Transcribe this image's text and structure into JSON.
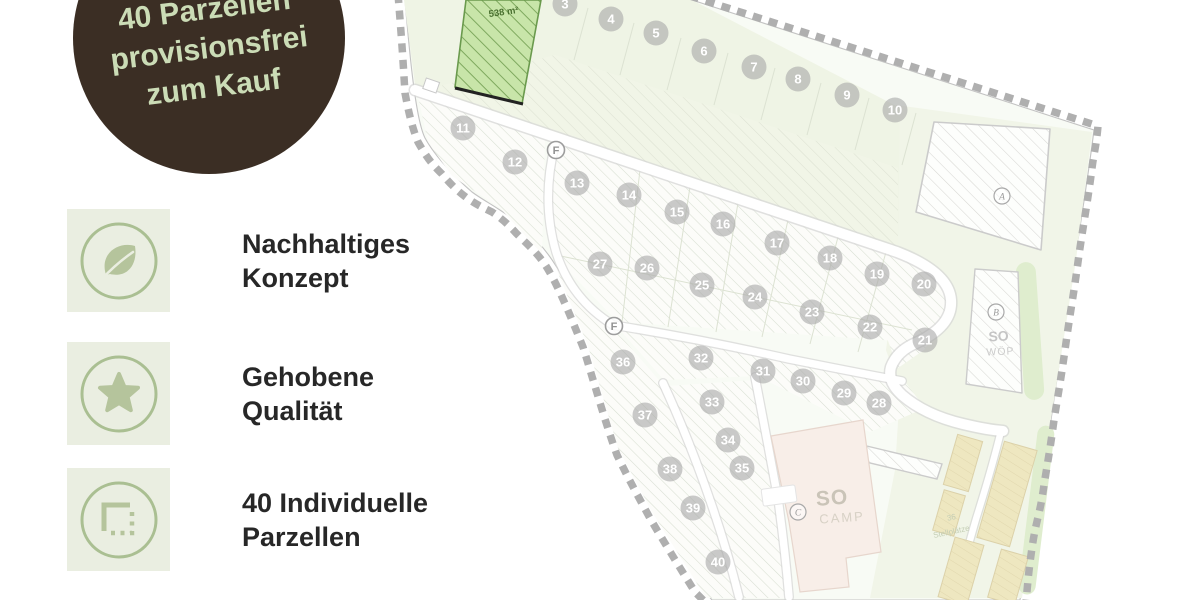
{
  "badge": {
    "line1": "40 Parzellen",
    "line2": "provisionsfrei",
    "line3": "zum Kauf"
  },
  "features": [
    {
      "icon": "leaf-icon",
      "l1": "Nachhaltiges",
      "l2": "Konzept"
    },
    {
      "icon": "star-icon",
      "l1": "Gehobene",
      "l2": "Qualität"
    },
    {
      "icon": "parcel-icon",
      "l1": "40 Individuelle",
      "l2": "Parzellen"
    }
  ],
  "colors": {
    "badge_bg": "#3b2e24",
    "badge_text": "#cbdcb6",
    "icon_green": "#b5c49c",
    "icon_circle": "#aabf92",
    "tile_bg": "#eaeee1",
    "heading_text": "#272727",
    "highlight_parcel": "#c8e5a9",
    "boundary_dash": "#afafaf",
    "parking_fill": "#eae0af",
    "vegetation": "#d6e8c0"
  },
  "siteplan": {
    "highlight_area_label": "538 m²",
    "parking_label_line1": "36",
    "parking_label_line2": "Stellplätze",
    "zone_so_camp": {
      "so": "SO",
      "name": "CAMP"
    },
    "zone_so_wop": {
      "so": "SO",
      "name": "WÖP"
    },
    "road_markers": [
      {
        "label": "F",
        "x": 556,
        "y": 150
      },
      {
        "label": "F",
        "x": 614,
        "y": 326
      }
    ],
    "letter_markers": [
      {
        "label": "A",
        "x": 1002,
        "y": 196
      },
      {
        "label": "B",
        "x": 996,
        "y": 312
      },
      {
        "label": "C",
        "x": 798,
        "y": 512
      }
    ],
    "parcels": [
      {
        "n": "3",
        "x": 565,
        "y": 4
      },
      {
        "n": "4",
        "x": 611,
        "y": 19
      },
      {
        "n": "5",
        "x": 656,
        "y": 33
      },
      {
        "n": "6",
        "x": 704,
        "y": 51
      },
      {
        "n": "7",
        "x": 754,
        "y": 67
      },
      {
        "n": "8",
        "x": 798,
        "y": 79
      },
      {
        "n": "9",
        "x": 847,
        "y": 95
      },
      {
        "n": "10",
        "x": 895,
        "y": 110
      },
      {
        "n": "11",
        "x": 463,
        "y": 128
      },
      {
        "n": "12",
        "x": 515,
        "y": 162
      },
      {
        "n": "13",
        "x": 577,
        "y": 183
      },
      {
        "n": "14",
        "x": 629,
        "y": 195
      },
      {
        "n": "15",
        "x": 677,
        "y": 212
      },
      {
        "n": "16",
        "x": 723,
        "y": 224
      },
      {
        "n": "17",
        "x": 777,
        "y": 243
      },
      {
        "n": "18",
        "x": 830,
        "y": 258
      },
      {
        "n": "19",
        "x": 877,
        "y": 274
      },
      {
        "n": "20",
        "x": 924,
        "y": 284
      },
      {
        "n": "21",
        "x": 925,
        "y": 340
      },
      {
        "n": "22",
        "x": 870,
        "y": 327
      },
      {
        "n": "23",
        "x": 812,
        "y": 312
      },
      {
        "n": "24",
        "x": 755,
        "y": 297
      },
      {
        "n": "25",
        "x": 702,
        "y": 285
      },
      {
        "n": "26",
        "x": 647,
        "y": 268
      },
      {
        "n": "27",
        "x": 600,
        "y": 264
      },
      {
        "n": "28",
        "x": 879,
        "y": 403
      },
      {
        "n": "29",
        "x": 844,
        "y": 393
      },
      {
        "n": "30",
        "x": 803,
        "y": 381
      },
      {
        "n": "31",
        "x": 763,
        "y": 371
      },
      {
        "n": "32",
        "x": 701,
        "y": 358
      },
      {
        "n": "33",
        "x": 712,
        "y": 402
      },
      {
        "n": "34",
        "x": 728,
        "y": 440
      },
      {
        "n": "35",
        "x": 742,
        "y": 468
      },
      {
        "n": "36",
        "x": 623,
        "y": 362
      },
      {
        "n": "37",
        "x": 645,
        "y": 415
      },
      {
        "n": "38",
        "x": 670,
        "y": 469
      },
      {
        "n": "39",
        "x": 693,
        "y": 508
      },
      {
        "n": "40",
        "x": 718,
        "y": 562
      }
    ]
  }
}
